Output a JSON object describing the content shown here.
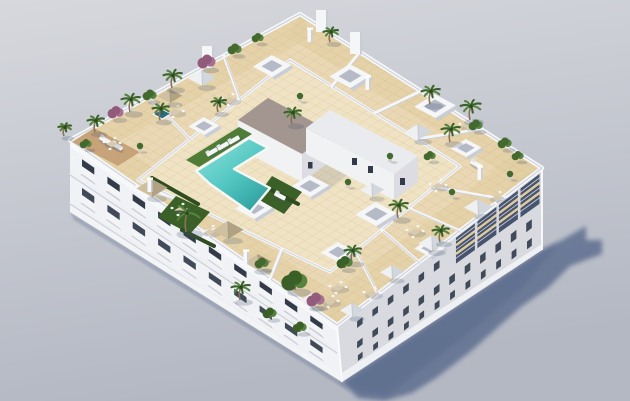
{
  "meta": {
    "description": "Aerial 3D architectural render of a white apartment building with a rooftop communal terrace: turquoise L-shaped pool, artificial grass, beige tiled deck, private terraces with parasols, palms and shrubs, strong cast shadow to the lower right on a plain grey ground."
  },
  "palette": {
    "bg_top": "#d6d8dd",
    "bg_bottom": "#b4b8c3",
    "shadow": "#57678a",
    "wall_white": "#f5f6f8",
    "parapet_edge": "#c9cdd6",
    "facade_sw": "#f1f2f5",
    "facade_se": "#d8dae0",
    "facade_se_dark": "#47546e",
    "window_dark": "#333b48",
    "window_mid": "#414a59",
    "balcony_front": "#f3f4f6",
    "slab_shadow": "#c3c7d1",
    "roof_tile": "#e9d8b3",
    "roof_tile_light": "#f0e4c5",
    "roof_band": "#dfcb9e",
    "grout": "#c2ae82",
    "wood": "#c7a379",
    "pool_light": "#92e2db",
    "pool_mid": "#55c8c3",
    "pool_deep": "#2d9f9e",
    "coping": "#f8f8f5",
    "jacuzzi": "#2a6d89",
    "grass": "#4f7c36",
    "grass_dark": "#3a5f27",
    "hedge": "#2f4d20",
    "palm": "#3c622b",
    "palm_light": "#578341",
    "bush": "#44692f",
    "purple": "#925a7b",
    "purple_light": "#a86f90",
    "trunk": "#8a7356",
    "core_roof": "#a39691",
    "core_wall_lit": "#f1f2f4",
    "core_wall_shade": "#dcdce2",
    "umb_tan": "#cfc1a0",
    "umb_tan_shade": "#b1a284",
    "umb_white": "#eef0f2",
    "umb_white_shade": "#d2d6dd",
    "furn_tan": "#d8cab0",
    "furn_white": "#f5f6f7"
  },
  "scene": {
    "skylights": [
      {
        "x": 272,
        "y": 66,
        "s": 11
      },
      {
        "x": 350,
        "y": 76,
        "s": 12
      },
      {
        "x": 435,
        "y": 106,
        "s": 12
      },
      {
        "x": 204,
        "y": 126,
        "s": 9
      },
      {
        "x": 310,
        "y": 186,
        "s": 11
      },
      {
        "x": 466,
        "y": 148,
        "s": 9
      },
      {
        "x": 254,
        "y": 208,
        "s": 11
      },
      {
        "x": 376,
        "y": 214,
        "s": 12
      },
      {
        "x": 338,
        "y": 252,
        "s": 10
      },
      {
        "x": 430,
        "y": 248,
        "s": 9
      }
    ],
    "umbrellas": [
      {
        "x": 202,
        "y": 78,
        "s": 8,
        "tone": "white"
      },
      {
        "x": 170,
        "y": 96,
        "s": 7,
        "tone": "tan"
      },
      {
        "x": 152,
        "y": 188,
        "s": 9,
        "tone": "tan"
      },
      {
        "x": 228,
        "y": 230,
        "s": 9,
        "tone": "tan"
      },
      {
        "x": 258,
        "y": 262,
        "s": 8,
        "tone": "tan"
      },
      {
        "x": 418,
        "y": 132,
        "s": 8,
        "tone": "white"
      },
      {
        "x": 372,
        "y": 190,
        "s": 7,
        "tone": "white"
      },
      {
        "x": 478,
        "y": 207,
        "s": 8,
        "tone": "white"
      },
      {
        "x": 432,
        "y": 243,
        "s": 8,
        "tone": "white"
      },
      {
        "x": 392,
        "y": 272,
        "s": 7,
        "tone": "white"
      },
      {
        "x": 352,
        "y": 310,
        "s": 7,
        "tone": "white"
      },
      {
        "x": 312,
        "y": 300,
        "s": 7,
        "tone": "white"
      }
    ],
    "furniture": [
      {
        "x": 230,
        "y": 100
      },
      {
        "x": 175,
        "y": 112
      },
      {
        "x": 112,
        "y": 144
      },
      {
        "x": 468,
        "y": 126
      },
      {
        "x": 438,
        "y": 186
      },
      {
        "x": 497,
        "y": 198
      },
      {
        "x": 415,
        "y": 232
      },
      {
        "x": 372,
        "y": 294
      },
      {
        "x": 338,
        "y": 288
      },
      {
        "x": 330,
        "y": 302
      },
      {
        "x": 180,
        "y": 210
      },
      {
        "x": 210,
        "y": 232
      }
    ],
    "loungers": [
      {
        "x": 212,
        "y": 152,
        "a": -30
      },
      {
        "x": 223,
        "y": 146,
        "a": -30
      },
      {
        "x": 234,
        "y": 140,
        "a": -30
      },
      {
        "x": 280,
        "y": 196,
        "a": 28
      },
      {
        "x": 105,
        "y": 140,
        "a": 28
      },
      {
        "x": 117,
        "y": 146,
        "a": 28
      },
      {
        "x": 476,
        "y": 164,
        "a": 28
      }
    ],
    "plants": [
      {
        "t": "palm",
        "x": 186,
        "y": 232,
        "s": 15
      },
      {
        "t": "palm",
        "x": 292,
        "y": 124,
        "s": 9
      },
      {
        "t": "palm",
        "x": 470,
        "y": 120,
        "s": 11
      },
      {
        "t": "palm",
        "x": 430,
        "y": 104,
        "s": 10
      },
      {
        "t": "palm",
        "x": 450,
        "y": 142,
        "s": 10
      },
      {
        "t": "palm",
        "x": 398,
        "y": 218,
        "s": 10
      },
      {
        "t": "palm",
        "x": 440,
        "y": 242,
        "s": 9
      },
      {
        "t": "palm",
        "x": 352,
        "y": 262,
        "s": 9
      },
      {
        "t": "palm",
        "x": 330,
        "y": 42,
        "s": 8
      },
      {
        "t": "palm",
        "x": 130,
        "y": 112,
        "s": 10
      },
      {
        "t": "palm",
        "x": 160,
        "y": 120,
        "s": 9
      },
      {
        "t": "palm",
        "x": 172,
        "y": 88,
        "s": 10
      },
      {
        "t": "palm",
        "x": 95,
        "y": 132,
        "s": 9
      },
      {
        "t": "palm",
        "x": 240,
        "y": 300,
        "s": 10
      },
      {
        "t": "palm",
        "x": 218,
        "y": 112,
        "s": 8
      },
      {
        "t": "palm",
        "x": 64,
        "y": 136,
        "s": 7
      },
      {
        "t": "tree",
        "x": 295,
        "y": 290,
        "s": 13
      },
      {
        "t": "tree",
        "x": 345,
        "y": 268,
        "s": 8
      },
      {
        "t": "tree",
        "x": 270,
        "y": 318,
        "s": 7
      },
      {
        "t": "tree",
        "x": 300,
        "y": 332,
        "s": 7
      },
      {
        "t": "purple",
        "x": 207,
        "y": 68,
        "s": 9
      },
      {
        "t": "purple",
        "x": 116,
        "y": 118,
        "s": 8
      },
      {
        "t": "purple",
        "x": 316,
        "y": 306,
        "s": 9
      },
      {
        "t": "bush",
        "x": 150,
        "y": 100,
        "s": 7
      },
      {
        "t": "bush",
        "x": 235,
        "y": 54,
        "s": 7
      },
      {
        "t": "bush",
        "x": 258,
        "y": 42,
        "s": 6
      },
      {
        "t": "bush",
        "x": 476,
        "y": 130,
        "s": 7
      },
      {
        "t": "bush",
        "x": 505,
        "y": 148,
        "s": 7
      },
      {
        "t": "bush",
        "x": 518,
        "y": 160,
        "s": 6
      },
      {
        "t": "bush",
        "x": 262,
        "y": 268,
        "s": 7
      },
      {
        "t": "bush",
        "x": 430,
        "y": 160,
        "s": 6
      },
      {
        "t": "bush",
        "x": 86,
        "y": 148,
        "s": 6
      },
      {
        "t": "pot",
        "x": 390,
        "y": 160,
        "s": 4
      },
      {
        "t": "pot",
        "x": 348,
        "y": 186,
        "s": 4
      },
      {
        "t": "pot",
        "x": 510,
        "y": 178,
        "s": 4
      },
      {
        "t": "pot",
        "x": 140,
        "y": 150,
        "s": 4
      },
      {
        "t": "pot",
        "x": 300,
        "y": 100,
        "s": 4
      },
      {
        "t": "pot",
        "x": 452,
        "y": 196,
        "s": 4
      }
    ],
    "divider_walls": [
      [
        224,
        56,
        240,
        100
      ],
      [
        148,
        97,
        190,
        139
      ],
      [
        360,
        52,
        332,
        86
      ],
      [
        421,
        91,
        375,
        113
      ],
      [
        481,
        129,
        417,
        139
      ],
      [
        501,
        199,
        434,
        187
      ],
      [
        460,
        231,
        408,
        208
      ],
      [
        419,
        262,
        382,
        230
      ],
      [
        378,
        294,
        356,
        251
      ],
      [
        137,
        186,
        186,
        203
      ],
      [
        203,
        232,
        234,
        226
      ],
      [
        270,
        279,
        282,
        249
      ]
    ],
    "hedges": [
      [
        152,
        178,
        198,
        204
      ],
      [
        264,
        186,
        298,
        204
      ],
      [
        182,
        230,
        214,
        246
      ]
    ],
    "grass_patches": [
      [
        [
          186,
          160
        ],
        [
          239,
          127
        ],
        [
          252,
          134
        ],
        [
          199,
          167
        ]
      ],
      [
        [
          272,
          176
        ],
        [
          302,
          192
        ],
        [
          284,
          214
        ],
        [
          256,
          198
        ]
      ],
      [
        [
          176,
          196
        ],
        [
          210,
          212
        ],
        [
          190,
          234
        ],
        [
          158,
          217
        ]
      ]
    ],
    "pool_polygon": [
      [
        196,
        171
      ],
      [
        249,
        138
      ],
      [
        268,
        148
      ],
      [
        234,
        169
      ],
      [
        270,
        188
      ],
      [
        250,
        212
      ],
      [
        210,
        184
      ]
    ],
    "jacuzzi": {
      "x": 162,
      "y": 114,
      "s": 5
    },
    "wood_deck": [
      [
        94,
        128
      ],
      [
        140,
        152
      ],
      [
        118,
        166
      ],
      [
        72,
        142
      ]
    ],
    "pillars": [
      [
        130,
        110
      ],
      [
        310,
        40
      ],
      [
        368,
        88
      ],
      [
        480,
        178
      ],
      [
        246,
        262
      ],
      [
        150,
        190
      ]
    ],
    "privacy_walls": [
      [
        322,
        28
      ],
      [
        356,
        50
      ],
      [
        208,
        64
      ]
    ],
    "facade_se": {
      "loggia_t": 0.42,
      "piers": [
        0.0,
        0.105,
        0.21,
        0.315,
        0.42
      ],
      "band": [
        4,
        34
      ],
      "slab_offs": [
        13,
        23
      ],
      "rail_offs": [
        8,
        18,
        28
      ],
      "rows": [
        {
          "off": 16,
          "w": 7,
          "h": 9,
          "ts": [
            0.5,
            0.575,
            0.65,
            0.725,
            0.8,
            0.875
          ]
        },
        {
          "off": 44,
          "w": 7,
          "h": 9,
          "ts": [
            0.05,
            0.125,
            0.2,
            0.275,
            0.35,
            0.425,
            0.5,
            0.575,
            0.65,
            0.725,
            0.8,
            0.875
          ]
        },
        {
          "off": 63,
          "w": 6,
          "h": 8,
          "ts": [
            0.05,
            0.125,
            0.2,
            0.275,
            0.35,
            0.425,
            0.5,
            0.575,
            0.65,
            0.725,
            0.8,
            0.875
          ]
        }
      ]
    },
    "facade_sw": {
      "bays": [
        0.045,
        0.14,
        0.235,
        0.33,
        0.425,
        0.52,
        0.615,
        0.71,
        0.805,
        0.9
      ],
      "floor_offs": [
        11,
        40
      ],
      "slab_offs": [
        33,
        62
      ],
      "open_w": 15,
      "open_h": 15
    }
  }
}
